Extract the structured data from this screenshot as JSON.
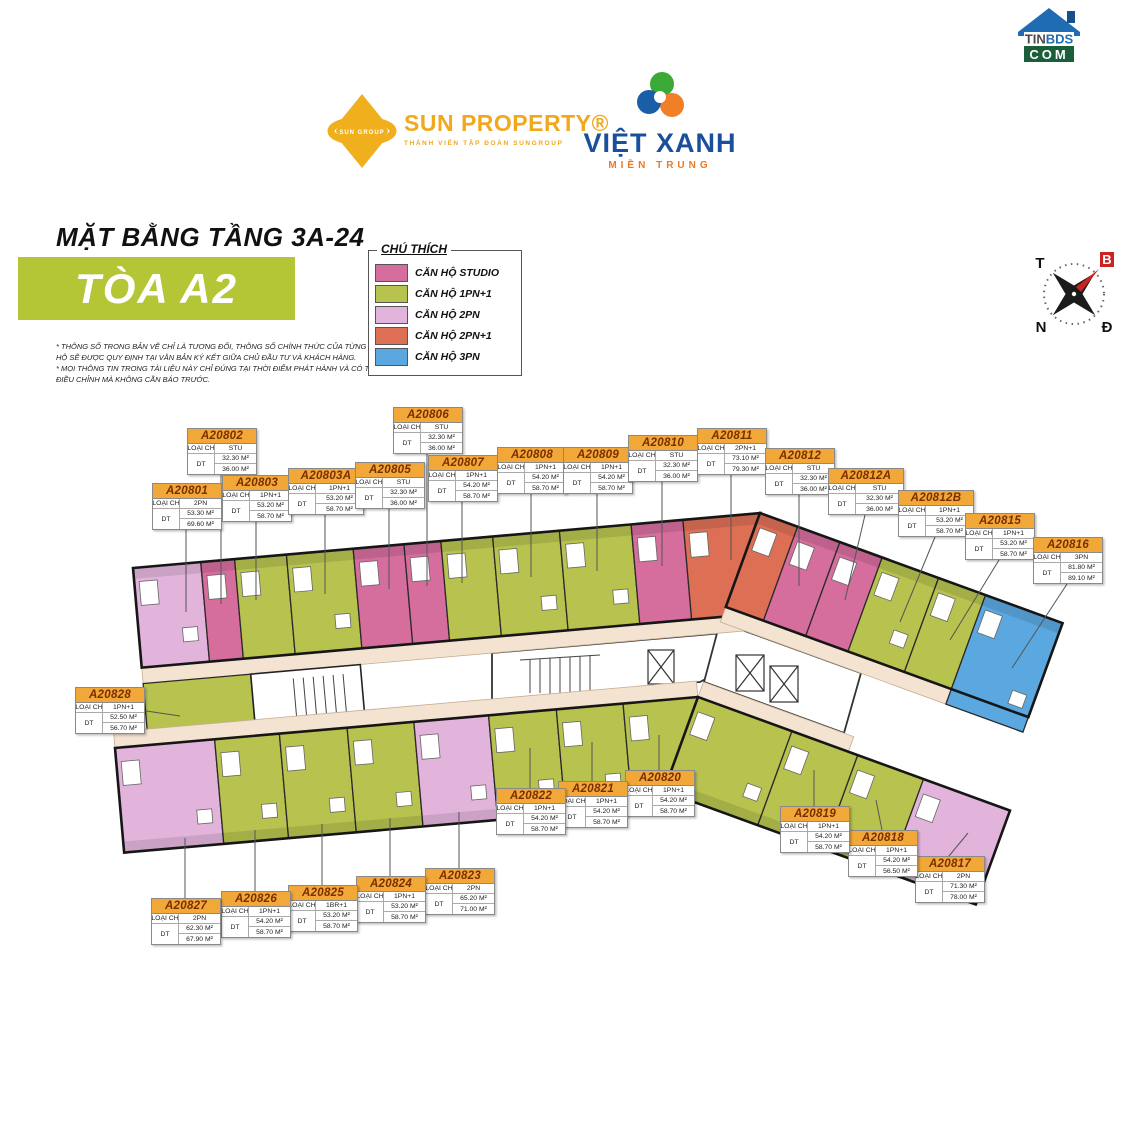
{
  "logos": {
    "sun_property": {
      "title": "SUN PROPERTY®",
      "tagline": "THÀNH VIÊN TẬP ĐOÀN SUNGROUP",
      "color": "#f0a81c"
    },
    "viet_xanh": {
      "title": "VIỆT XANH",
      "subtitle": "MIỀN TRUNG"
    },
    "tinbds": {
      "line1": "TINBDS",
      "line2": "COM"
    }
  },
  "header": {
    "floor_title": "MẶT BẰNG TẦNG 3A-24",
    "tower_title": "TÒA A2",
    "disclaimer_line1": "* THÔNG SỐ TRONG BẢN VẼ CHỈ LÀ TƯƠNG ĐỐI, THÔNG SỐ CHÍNH THỨC CỦA TỪNG CĂN HỘ SẼ ĐƯỢC QUY ĐỊNH TẠI VĂN BẢN KÝ KẾT GIỮA CHỦ ĐẦU TƯ VÀ KHÁCH HÀNG.",
    "disclaimer_line2": "* MỌI THÔNG TIN TRONG TÀI LIỆU NÀY CHỈ ĐÚNG TẠI THỜI ĐIỂM PHÁT HÀNH VÀ CÓ THỂ ĐIỀU CHỈNH MÀ KHÔNG CẦN BÁO TRƯỚC."
  },
  "legend": {
    "title": "CHÚ THÍCH",
    "items": [
      {
        "type": "studio",
        "label": "CĂN HỘ STUDIO",
        "color": "#d56d9d"
      },
      {
        "type": "1pn1",
        "label": "CĂN HỘ 1PN+1",
        "color": "#b7c24f"
      },
      {
        "type": "2pn",
        "label": "CĂN HỘ 2PN",
        "color": "#e2b4dc"
      },
      {
        "type": "2pn1",
        "label": "CĂN HỘ 2PN+1",
        "color": "#dd6f55"
      },
      {
        "type": "3pn",
        "label": "CĂN HỘ 3PN",
        "color": "#5ba7e0"
      }
    ]
  },
  "colors": {
    "tower_box": "#b4c636",
    "label_header": "#f2a838",
    "corridor": "#f4e3d1",
    "compass_needle": "#cc2222"
  },
  "compass": {
    "north": "B",
    "east": "Đ",
    "south": "N",
    "west": "T"
  },
  "labels": {
    "type_label": "LOẠI CH",
    "area_label": "DT"
  },
  "units": [
    {
      "id": "A20801",
      "type_key": "2pn",
      "type_value": "2PN",
      "area1": "53.30 M²",
      "area2": "69.60 M²",
      "box": {
        "left": 152,
        "top": 483
      },
      "line_to": {
        "x": 186,
        "y": 612
      }
    },
    {
      "id": "A20802",
      "type_key": "studio",
      "type_value": "STU",
      "area1": "32.30 M²",
      "area2": "36.00 M²",
      "box": {
        "left": 187,
        "top": 428
      },
      "line_to": {
        "x": 221,
        "y": 604
      }
    },
    {
      "id": "A20803",
      "type_key": "1pn1",
      "type_value": "1PN+1",
      "area1": "53.20 M²",
      "area2": "58.70 M²",
      "box": {
        "left": 222,
        "top": 475
      },
      "line_to": {
        "x": 256,
        "y": 600
      }
    },
    {
      "id": "A20803A",
      "type_key": "1pn1",
      "type_value": "1PN+1",
      "area1": "53.20 M²",
      "area2": "58.70 M²",
      "box": {
        "left": 288,
        "top": 468
      },
      "line_to": {
        "x": 325,
        "y": 594
      }
    },
    {
      "id": "A20805",
      "type_key": "studio",
      "type_value": "STU",
      "area1": "32.30 M²",
      "area2": "36.00 M²",
      "box": {
        "left": 355,
        "top": 462
      },
      "line_to": {
        "x": 389,
        "y": 589
      }
    },
    {
      "id": "A20806",
      "type_key": "studio",
      "type_value": "STU",
      "area1": "32.30 M²",
      "area2": "36.00 M²",
      "box": {
        "left": 393,
        "top": 407
      },
      "line_to": {
        "x": 427,
        "y": 586
      }
    },
    {
      "id": "A20807",
      "type_key": "1pn1",
      "type_value": "1PN+1",
      "area1": "54.20 M²",
      "area2": "58.70 M²",
      "box": {
        "left": 428,
        "top": 455
      },
      "line_to": {
        "x": 462,
        "y": 583
      }
    },
    {
      "id": "A20808",
      "type_key": "1pn1",
      "type_value": "1PN+1",
      "area1": "54.20 M²",
      "area2": "58.70 M²",
      "box": {
        "left": 497,
        "top": 447
      },
      "line_to": {
        "x": 531,
        "y": 577
      }
    },
    {
      "id": "A20809",
      "type_key": "1pn1",
      "type_value": "1PN+1",
      "area1": "54.20 M²",
      "area2": "58.70 M²",
      "box": {
        "left": 563,
        "top": 447
      },
      "line_to": {
        "x": 597,
        "y": 571
      }
    },
    {
      "id": "A20810",
      "type_key": "studio",
      "type_value": "STU",
      "area1": "32.30 M²",
      "area2": "36.00 M²",
      "box": {
        "left": 628,
        "top": 435
      },
      "line_to": {
        "x": 662,
        "y": 566
      }
    },
    {
      "id": "A20811",
      "type_key": "2pn1",
      "type_value": "2PN+1",
      "area1": "73.10 M²",
      "area2": "79.30 M²",
      "box": {
        "left": 697,
        "top": 428
      },
      "line_to": {
        "x": 731,
        "y": 560
      }
    },
    {
      "id": "A20812",
      "type_key": "studio",
      "type_value": "STU",
      "area1": "32.30 M²",
      "area2": "36.00 M²",
      "box": {
        "left": 765,
        "top": 448
      },
      "line_to": {
        "x": 799,
        "y": 586
      }
    },
    {
      "id": "A20812A",
      "type_key": "studio",
      "type_value": "STU",
      "area1": "32.30 M²",
      "area2": "36.00 M²",
      "box": {
        "left": 828,
        "top": 468
      },
      "line_to": {
        "x": 845,
        "y": 600
      }
    },
    {
      "id": "A20812B",
      "type_key": "1pn1",
      "type_value": "1PN+1",
      "area1": "53.20 M²",
      "area2": "58.70 M²",
      "box": {
        "left": 898,
        "top": 490
      },
      "line_to": {
        "x": 900,
        "y": 622
      }
    },
    {
      "id": "A20815",
      "type_key": "1pn1",
      "type_value": "1PN+1",
      "area1": "53.20 M²",
      "area2": "58.70 M²",
      "box": {
        "left": 965,
        "top": 513
      },
      "line_to": {
        "x": 950,
        "y": 640
      }
    },
    {
      "id": "A20816",
      "type_key": "3pn",
      "type_value": "3PN",
      "area1": "81.80 M²",
      "area2": "89.10 M²",
      "box": {
        "left": 1033,
        "top": 537
      },
      "line_to": {
        "x": 1012,
        "y": 668
      }
    },
    {
      "id": "A20817",
      "type_key": "2pn",
      "type_value": "2PN",
      "area1": "71.30 M²",
      "area2": "78.00 M²",
      "box": {
        "left": 915,
        "top": 856
      },
      "line_to": {
        "x": 968,
        "y": 833
      }
    },
    {
      "id": "A20818",
      "type_key": "1pn1",
      "type_value": "1PN+1",
      "area1": "54.20 M²",
      "area2": "56.50 M²",
      "box": {
        "left": 848,
        "top": 830
      },
      "line_to": {
        "x": 876,
        "y": 800
      }
    },
    {
      "id": "A20819",
      "type_key": "1pn1",
      "type_value": "1PN+1",
      "area1": "54.20 M²",
      "area2": "58.70 M²",
      "box": {
        "left": 780,
        "top": 806
      },
      "line_to": {
        "x": 814,
        "y": 770
      }
    },
    {
      "id": "A20820",
      "type_key": "1pn1",
      "type_value": "1PN+1",
      "area1": "54.20 M²",
      "area2": "58.70 M²",
      "box": {
        "left": 625,
        "top": 770
      },
      "line_to": {
        "x": 659,
        "y": 735
      }
    },
    {
      "id": "A20821",
      "type_key": "1pn1",
      "type_value": "1PN+1",
      "area1": "54.20 M²",
      "area2": "58.70 M²",
      "box": {
        "left": 558,
        "top": 781
      },
      "line_to": {
        "x": 592,
        "y": 742
      }
    },
    {
      "id": "A20822",
      "type_key": "1pn1",
      "type_value": "1PN+1",
      "area1": "54.20 M²",
      "area2": "58.70 M²",
      "box": {
        "left": 496,
        "top": 788
      },
      "line_to": {
        "x": 530,
        "y": 748
      }
    },
    {
      "id": "A20823",
      "type_key": "2pn",
      "type_value": "2PN",
      "area1": "65.20 M²",
      "area2": "71.00 M²",
      "box": {
        "left": 425,
        "top": 868
      },
      "line_to": {
        "x": 459,
        "y": 812
      }
    },
    {
      "id": "A20824",
      "type_key": "1pn1",
      "type_value": "1PN+1",
      "area1": "53.20 M²",
      "area2": "58.70 M²",
      "box": {
        "left": 356,
        "top": 876
      },
      "line_to": {
        "x": 390,
        "y": 818
      }
    },
    {
      "id": "A20825",
      "type_key": "1pn1",
      "type_value": "1BR+1",
      "area1": "53.20 M²",
      "area2": "58.70 M²",
      "box": {
        "left": 288,
        "top": 885
      },
      "line_to": {
        "x": 322,
        "y": 824
      }
    },
    {
      "id": "A20826",
      "type_key": "1pn1",
      "type_value": "1PN+1",
      "area1": "54.20 M²",
      "area2": "58.70 M²",
      "box": {
        "left": 221,
        "top": 891
      },
      "line_to": {
        "x": 255,
        "y": 830
      }
    },
    {
      "id": "A20827",
      "type_key": "2pn",
      "type_value": "2PN",
      "area1": "62.30 M²",
      "area2": "67.90 M²",
      "box": {
        "left": 151,
        "top": 898
      },
      "line_to": {
        "x": 185,
        "y": 838
      }
    },
    {
      "id": "A20828",
      "type_key": "1pn1",
      "type_value": "1PN+1",
      "area1": "52.50 M²",
      "area2": "56.70 M²",
      "box": {
        "left": 75,
        "top": 687
      },
      "line_to": {
        "x": 180,
        "y": 716
      }
    }
  ]
}
